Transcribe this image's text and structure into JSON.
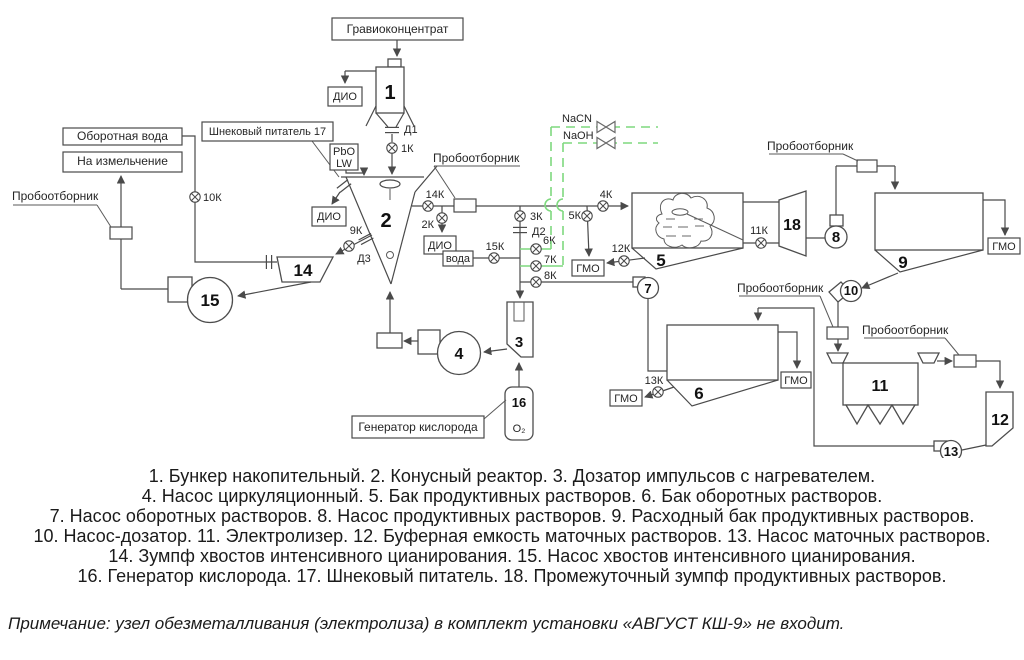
{
  "diagram": {
    "labels": {
      "gravioconcentrate": "Гравиоконцентрат",
      "screw_feeder_callout": "Шнековый питатель 17",
      "pbo": "PbO",
      "lw": "LW",
      "dio": "ДИО",
      "recycled_water": "Оборотная вода",
      "to_grinding": "На измельчение",
      "sampler": "Пробоотборник",
      "water": "вода",
      "nacn": "NaCN",
      "naoh": "NaOH",
      "gmo": "ГМО",
      "oxygen_generator": "Генератор кислорода",
      "o2": "O₂"
    },
    "valves": {
      "k1": "1К",
      "k2": "2К",
      "k3": "3К",
      "k4": "4К",
      "k5": "5К",
      "k6": "6К",
      "k7": "7К",
      "k8": "8К",
      "k9": "9К",
      "k10": "10К",
      "k11": "11К",
      "k12": "12К",
      "k13": "13К",
      "k14": "14К",
      "k15": "15К",
      "d1": "Д1",
      "d2": "Д2",
      "d3": "Д3"
    },
    "equipment": {
      "e1": "1",
      "e2": "2",
      "e3": "3",
      "e4": "4",
      "e5": "5",
      "e6": "6",
      "e7": "7",
      "e8": "8",
      "e9": "9",
      "e10": "10",
      "e11": "11",
      "e12": "12",
      "e13": "13",
      "e14": "14",
      "e15": "15",
      "e16": "16",
      "e17": "17",
      "e18": "18"
    },
    "colors": {
      "diagram_line": "#4a4a4a",
      "reagent_line_green": "#7fd97f",
      "text": "#1b1b1b"
    }
  },
  "legend": {
    "lines": [
      "1. Бункер накопительный. 2. Конусный реактор. 3. Дозатор импульсов с нагревателем.",
      "4. Насос циркуляционный. 5. Бак продуктивных растворов. 6. Бак оборотных растворов.",
      "7. Насос оборотных растворов.  8. Насос продуктивных растворов. 9. Расходный бак продуктивных растворов.",
      "10. Насос-дозатор. 11. Электролизер. 12. Буферная емкость маточных растворов. 13. Насос маточных растворов.",
      "14. Зумпф хвостов интенсивного цианирования. 15. Насос хвостов интенсивного цианирования.",
      "16. Генератор кислорода. 17. Шнековый питатель. 18. Промежуточный зумпф продуктивных растворов."
    ]
  },
  "note": "Примечание: узел обезметалливания (электролиза) в комплект установки «АВГУСТ КШ-9» не входит."
}
